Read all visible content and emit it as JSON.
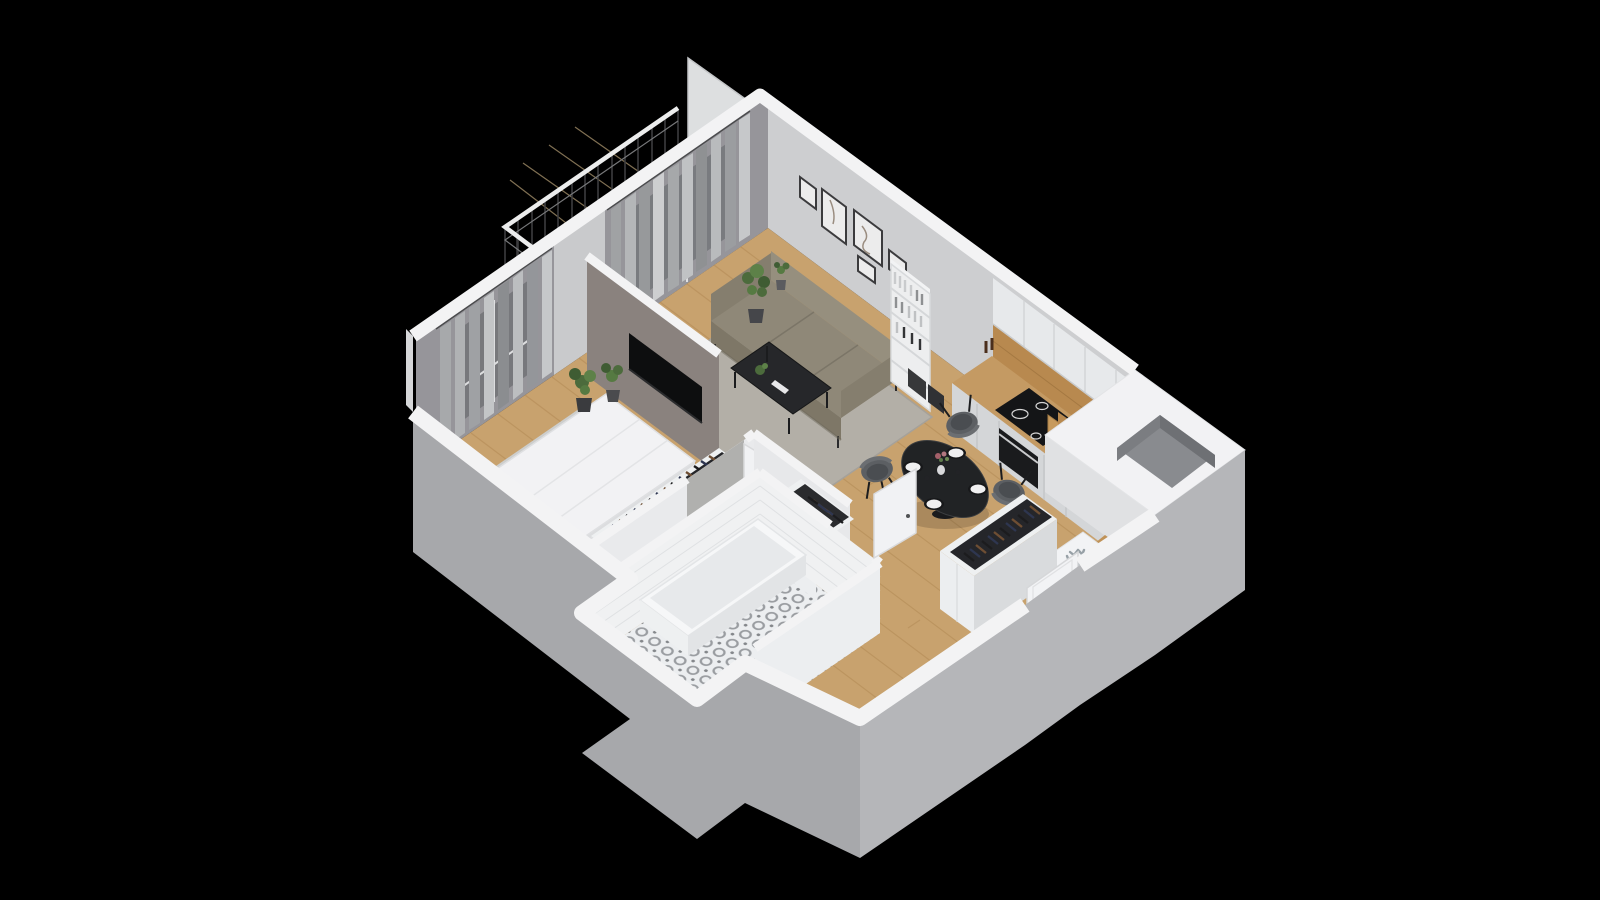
{
  "scene": {
    "background_color": "#000000"
  },
  "icons": {
    "fridge_marker": "snowflake-icon"
  },
  "colors": {
    "background": "#000000",
    "wall_gray": "#96959a",
    "wall_light": "#cdced0",
    "wall_white": "#f3f3f4",
    "partition_taupe": "#8a827e",
    "floor_wood": "#c8a26e",
    "rug_living": "#b3afa7",
    "rug_bedroom": "#cdcecd",
    "sofa": "#8f8878",
    "kitchen_wood": "#b8894f",
    "counter_wood": "#c49a63",
    "appliance_black": "#141517",
    "table_black": "#212325",
    "chair_gray": "#5c5f63",
    "fridge_white": "#f2f3f5",
    "snowflake": "#97a0a6",
    "bed_white": "#f2f2f4",
    "tile_white": "#f0f1f2",
    "mat_black": "#121212",
    "exterior_light": "#b5b6b9",
    "exterior_dark": "#a7a8ab",
    "balcony_floor": "#c9b38c",
    "clothes_dark": "#25262a",
    "plant_green": "#4c6b3c"
  }
}
